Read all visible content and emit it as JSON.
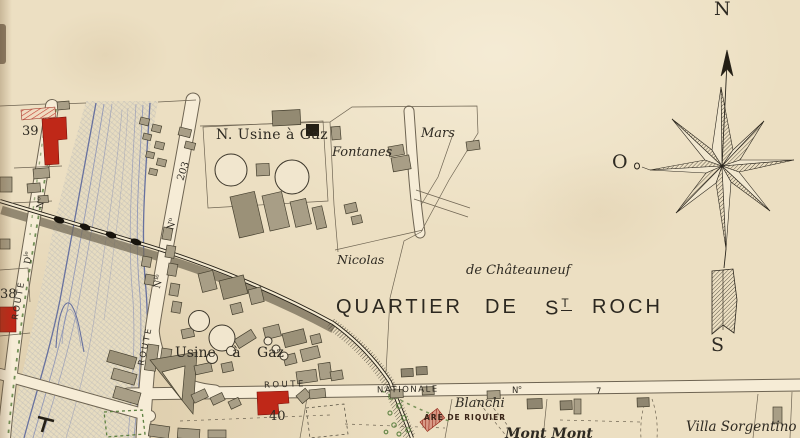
{
  "map": {
    "title": {
      "w1": "QUARTIER",
      "w2": "DE",
      "w3": "S",
      "w3sup": "T",
      "w4": "ROCH"
    },
    "places": {
      "n_usine_a_gaz": "N. Usine à Gaz",
      "fontanes": "Fontanes",
      "mars": "Mars",
      "nicolas": "Nicolas",
      "de_chateauneuf": "de Châteauneuf",
      "usine_a_gaz": "Usine à Gaz",
      "blanchi": "Blanchi",
      "gare_riquier": "ARE DE RIQUIER",
      "mont_mont": "Mont Mont",
      "villa_sorgentino": "Villa Sorgentino"
    },
    "roads": {
      "route": "ROUTE",
      "nationale": "NATIONALE",
      "no_base": "N",
      "no_sup": "o",
      "seven": "7",
      "n203": "203",
      "nle_base": "N",
      "nle_sup": "le",
      "dle_base": "D",
      "dle_sup": "le"
    },
    "plots": {
      "n38": "38",
      "n39": "39",
      "n40": "40"
    },
    "compass": {
      "north": "N",
      "west": "O",
      "south": "S"
    },
    "colors": {
      "paper": "#ecdfc2",
      "ink": "#2e2a22",
      "building_gray": "#a89e86",
      "building_red": "#bf2818",
      "river_blue": "#7b86b4",
      "green": "#5c8040",
      "road_fill": "#f6ecd6",
      "line": "#6e6452"
    }
  }
}
